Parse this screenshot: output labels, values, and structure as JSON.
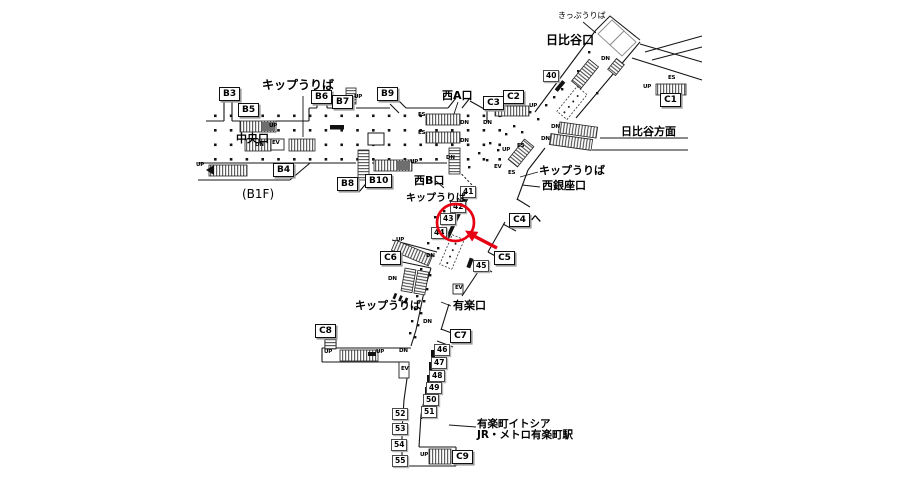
{
  "map_title": "station-concourse-map",
  "floor": "(B1F)",
  "marker": {
    "color": "#e60012",
    "shape": "circle-with-arrow",
    "highlighted_position": "43"
  },
  "exits": [
    {
      "id": "B3",
      "x": 219,
      "y": 87
    },
    {
      "id": "B5",
      "x": 238,
      "y": 103
    },
    {
      "id": "B6",
      "x": 311,
      "y": 90
    },
    {
      "id": "B7",
      "x": 332,
      "y": 95
    },
    {
      "id": "B9",
      "x": 377,
      "y": 87
    },
    {
      "id": "C3",
      "x": 483,
      "y": 96
    },
    {
      "id": "C2",
      "x": 503,
      "y": 90
    },
    {
      "id": "C1",
      "x": 660,
      "y": 93
    },
    {
      "id": "B4",
      "x": 273,
      "y": 163
    },
    {
      "id": "B8",
      "x": 337,
      "y": 177
    },
    {
      "id": "B10",
      "x": 365,
      "y": 174
    },
    {
      "id": "C4",
      "x": 509,
      "y": 213,
      "suffix": "へ"
    },
    {
      "id": "C5",
      "x": 494,
      "y": 251
    },
    {
      "id": "C6",
      "x": 380,
      "y": 251
    },
    {
      "id": "C7",
      "x": 450,
      "y": 329
    },
    {
      "id": "C8",
      "x": 315,
      "y": 324
    },
    {
      "id": "C9",
      "x": 452,
      "y": 450
    }
  ],
  "positions": [
    {
      "id": "40",
      "x": 543,
      "y": 70
    },
    {
      "id": "41",
      "x": 460,
      "y": 186
    },
    {
      "id": "42",
      "x": 450,
      "y": 201
    },
    {
      "id": "43",
      "x": 440,
      "y": 213
    },
    {
      "id": "44",
      "x": 431,
      "y": 227
    },
    {
      "id": "45",
      "x": 473,
      "y": 260
    },
    {
      "id": "46",
      "x": 434,
      "y": 344
    },
    {
      "id": "47",
      "x": 431,
      "y": 357
    },
    {
      "id": "48",
      "x": 429,
      "y": 370
    },
    {
      "id": "49",
      "x": 426,
      "y": 382
    },
    {
      "id": "50",
      "x": 423,
      "y": 394
    },
    {
      "id": "51",
      "x": 421,
      "y": 406
    },
    {
      "id": "52",
      "x": 392,
      "y": 408
    },
    {
      "id": "53",
      "x": 392,
      "y": 423
    },
    {
      "id": "54",
      "x": 391,
      "y": 439
    },
    {
      "id": "55",
      "x": 392,
      "y": 455
    }
  ],
  "area_labels": [
    {
      "name": "ticket-office-top",
      "text": "きっぷうりば",
      "x": 558,
      "y": 12,
      "size": 8,
      "bold": false
    },
    {
      "name": "hibiya-exit",
      "text": "日比谷口",
      "x": 546,
      "y": 34,
      "size": 12,
      "bold": true
    },
    {
      "name": "ticket-office-west",
      "text": "キップうりば",
      "x": 262,
      "y": 79,
      "size": 12,
      "bold": true
    },
    {
      "name": "central-exit",
      "text": "中央口",
      "x": 236,
      "y": 133,
      "size": 11,
      "bold": true
    },
    {
      "name": "west-a-exit",
      "text": "西A口",
      "x": 442,
      "y": 90,
      "size": 11,
      "bold": true
    },
    {
      "name": "west-b-exit",
      "text": "西B口",
      "x": 414,
      "y": 175,
      "size": 11,
      "bold": true
    },
    {
      "name": "ticket-office-mid",
      "text": "キップうりば",
      "x": 406,
      "y": 194,
      "size": 10,
      "bold": true
    },
    {
      "name": "hibiya-direction",
      "text": "日比谷方面",
      "x": 621,
      "y": 126,
      "size": 11,
      "bold": true
    },
    {
      "name": "ticket-office-east",
      "text": "キップうりば",
      "x": 539,
      "y": 165,
      "size": 11,
      "bold": true
    },
    {
      "name": "west-ginza-exit",
      "text": "西銀座口",
      "x": 542,
      "y": 180,
      "size": 11,
      "bold": true
    },
    {
      "name": "yuraku-exit",
      "text": "有楽口",
      "x": 453,
      "y": 300,
      "size": 11,
      "bold": true
    },
    {
      "name": "ticket-office-south",
      "text": "キップうりば",
      "x": 355,
      "y": 300,
      "size": 11,
      "bold": true
    },
    {
      "name": "floor-label",
      "text": "(B1F)",
      "x": 242,
      "y": 188,
      "size": 12,
      "bold": false
    },
    {
      "name": "yurakucho-itocia",
      "text": "有楽町イトシア",
      "x": 477,
      "y": 419,
      "size": 10.5,
      "bold": true
    },
    {
      "name": "jr-metro-yurakucho",
      "text": "JR・メトロ有楽町駅",
      "x": 477,
      "y": 430,
      "size": 10.5,
      "bold": true
    }
  ],
  "small_labels": [
    {
      "t": "UP",
      "x": 196,
      "y": 163
    },
    {
      "t": "UP",
      "x": 269,
      "y": 124
    },
    {
      "t": "UP",
      "x": 354,
      "y": 95
    },
    {
      "t": "UP",
      "x": 410,
      "y": 160
    },
    {
      "t": "UP",
      "x": 529,
      "y": 104
    },
    {
      "t": "UP",
      "x": 643,
      "y": 85
    },
    {
      "t": "UP",
      "x": 396,
      "y": 238
    },
    {
      "t": "UP",
      "x": 324,
      "y": 350
    },
    {
      "t": "UP",
      "x": 376,
      "y": 350
    },
    {
      "t": "UP",
      "x": 420,
      "y": 453
    },
    {
      "t": "UP",
      "x": 502,
      "y": 148
    },
    {
      "t": "DN",
      "x": 483,
      "y": 121
    },
    {
      "t": "DN",
      "x": 460,
      "y": 121
    },
    {
      "t": "DN",
      "x": 460,
      "y": 139
    },
    {
      "t": "DN",
      "x": 446,
      "y": 156
    },
    {
      "t": "DN",
      "x": 551,
      "y": 125
    },
    {
      "t": "DN",
      "x": 541,
      "y": 137
    },
    {
      "t": "DN",
      "x": 601,
      "y": 57
    },
    {
      "t": "DN",
      "x": 426,
      "y": 254
    },
    {
      "t": "DN",
      "x": 388,
      "y": 277
    },
    {
      "t": "DN",
      "x": 423,
      "y": 320
    },
    {
      "t": "DN",
      "x": 399,
      "y": 349
    },
    {
      "t": "DN",
      "x": 255,
      "y": 143
    },
    {
      "t": "ES",
      "x": 418,
      "y": 113
    },
    {
      "t": "ES",
      "x": 418,
      "y": 131
    },
    {
      "t": "ES",
      "x": 668,
      "y": 76
    },
    {
      "t": "ES",
      "x": 517,
      "y": 144
    },
    {
      "t": "ES",
      "x": 508,
      "y": 171
    },
    {
      "t": "EV",
      "x": 272,
      "y": 141
    },
    {
      "t": "EV",
      "x": 494,
      "y": 165
    },
    {
      "t": "EV",
      "x": 455,
      "y": 286
    },
    {
      "t": "EV",
      "x": 401,
      "y": 367
    }
  ]
}
